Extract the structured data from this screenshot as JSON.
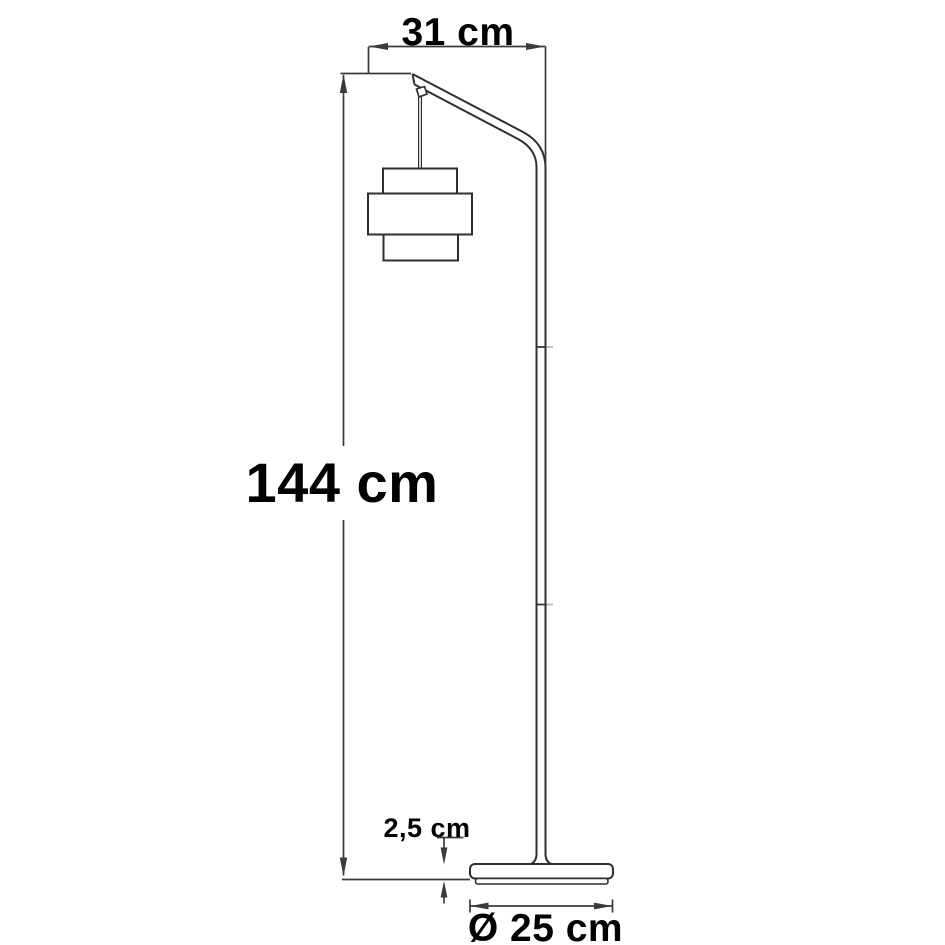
{
  "diagram": {
    "subject": "floor-lamp-dimension-drawing",
    "background_color": "#ffffff",
    "line_color": "#2f2f2f",
    "dimension_line_color": "#3a3a3a",
    "text_color": "#000000",
    "labels": {
      "width": "31 cm",
      "height": "144 cm",
      "base_thickness": "2,5 cm",
      "base_diameter": "Ø 25 cm"
    }
  }
}
